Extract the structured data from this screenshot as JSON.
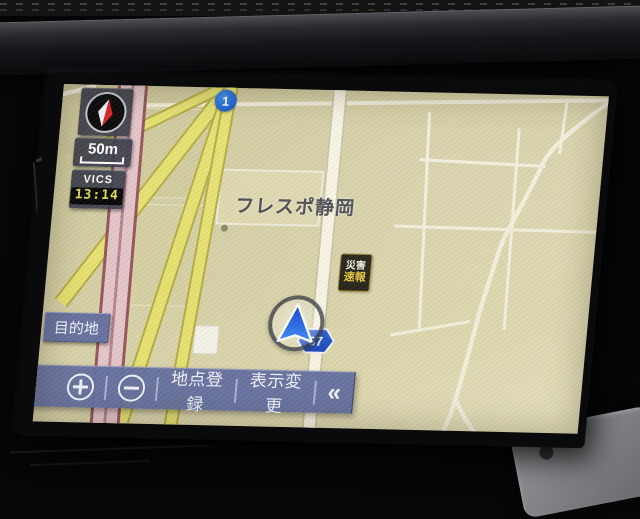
{
  "device": {
    "type": "in-car navigation touchscreen"
  },
  "widgets": {
    "compass_icon": "north-needle-compass",
    "scale_label": "50m",
    "vics_label": "VICS",
    "vics_time": "13:14"
  },
  "buttons": {
    "destination": "目的地",
    "zoom_in_icon": "plus-circle",
    "zoom_out_icon": "minus-circle",
    "register_point": "地点登録",
    "display_change": "表示変更",
    "collapse": "«"
  },
  "map": {
    "place_label": "フレスポ静岡",
    "position_icon": "vehicle-position-arrow",
    "route_badges": {
      "national": "1",
      "prefectural": "67"
    },
    "alert_badge": {
      "line1": "災害",
      "line2": "速報"
    }
  },
  "colors": {
    "map_background": "#d6d0a6",
    "toolbar_blue": "#646e9e",
    "road_yellow": "#e6e170",
    "road_major_pink": "#e3c5c9",
    "road_white": "#f7f4e4",
    "route_badge_blue": "#1f55c4",
    "vics_time_yellow": "#e3dd55",
    "needle_red": "#d8262a"
  }
}
